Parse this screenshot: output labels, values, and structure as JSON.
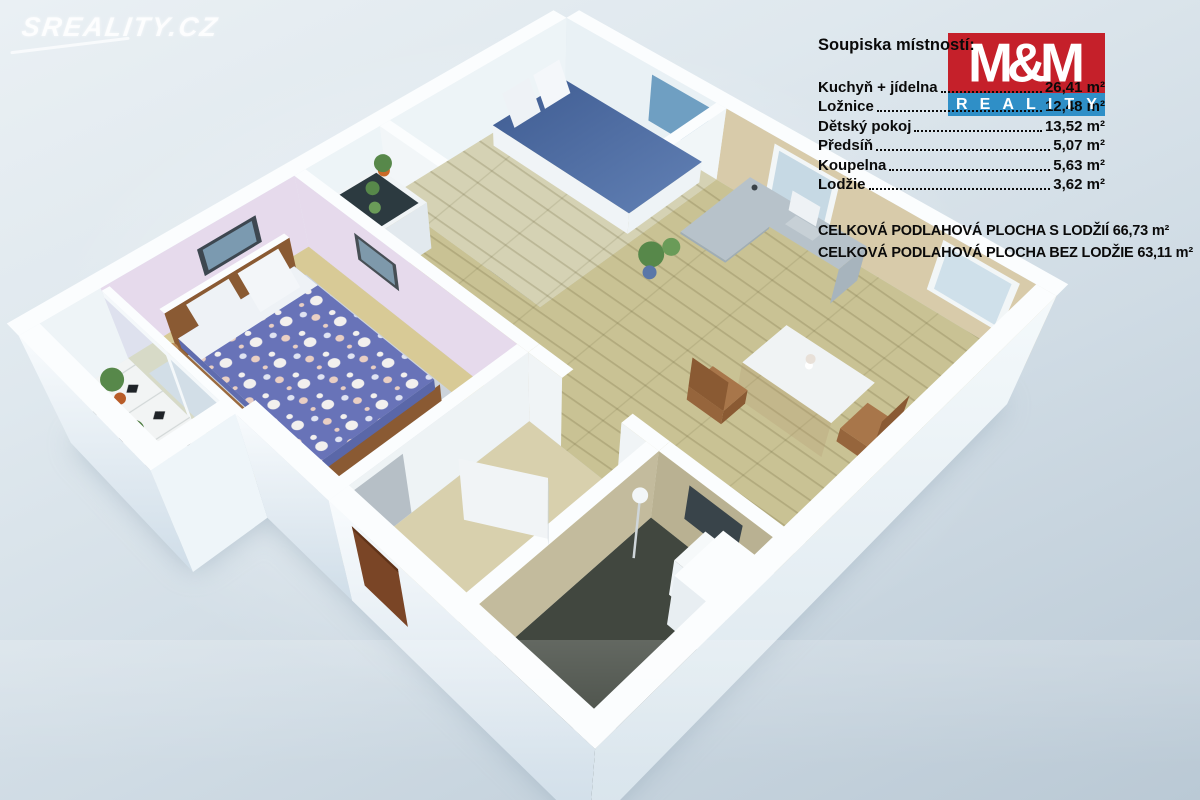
{
  "watermark": "SREALITY.CZ",
  "logo": {
    "mm": "M&M",
    "reality": "REALITY",
    "red": "#c5202a",
    "blue": "#2f8fc7"
  },
  "room_list": {
    "title": "Soupiska místností:",
    "rows": [
      {
        "label": "Kuchyň + jídelna",
        "value": "26,41 m²"
      },
      {
        "label": "Ložnice",
        "value": "12,48 m²"
      },
      {
        "label": "Dětský pokoj",
        "value": "13,52 m²"
      },
      {
        "label": "Předsíň",
        "value": "5,07 m²"
      },
      {
        "label": "Koupelna",
        "value": "5,63 m²"
      },
      {
        "label": "Lodžie",
        "value": "3,62 m²"
      }
    ],
    "totals": [
      "CELKOVÁ PODLAHOVÁ PLOCHA S LODŽIÍ 66,73 m²",
      "CELKOVÁ PODLAHOVÁ PLOCHA BEZ LODŽIE 63,11 m²"
    ]
  },
  "scene": {
    "background_top": "#eaf0f4",
    "background_bottom": "#bac9d5",
    "wall_white": "#f4f8fa",
    "kitchen_wall": "#d8cbaa",
    "khaki_wall": "#b9b192",
    "bedroom_wall": "#e6daec",
    "wood_floor": "#c9c294",
    "children_floor": "#d5d2b4",
    "bedroom_floor": "#d8ca96",
    "hall_floor": "#d8d0ad",
    "bath_floor": "#41473f",
    "rug_gray": "#ccd3db",
    "bed_blue": "#46659c",
    "duvet_blue": "#6873b8",
    "accent_red": "#d21414",
    "plant_green": "#57884a",
    "door_brown": "#7a4526",
    "chair_brown": "#8a5a33",
    "tile_white": "#f2f4f4",
    "glass_blue": "#bcd6e4"
  }
}
